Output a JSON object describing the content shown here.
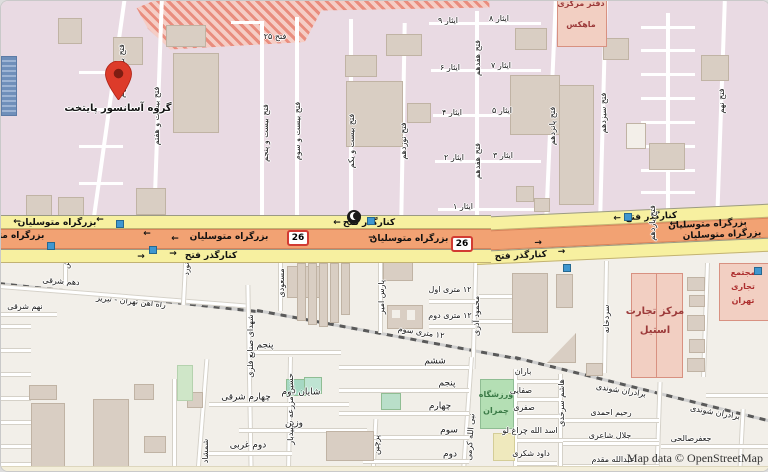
{
  "attribution": "Map data © OpenStreetMap",
  "roads": {
    "highway_main": "بزرگراه متوسلیان",
    "highway_side": "کنارگذر فتح",
    "shield": "26",
    "railway": "راه آهن تهران - تبریز"
  },
  "streets": {
    "fath29": "فتح بیست و نهم",
    "fath27": "فتح بیست و هفتم",
    "fath25_short": "فتح ۲۵",
    "fath25": "فتح بیست و پنجم",
    "fath23": "فتح بیست و سوم",
    "fath21": "فتح بیست و یکم",
    "fath19": "فتح نوزدهم",
    "fath17": "فتح هفدهم",
    "fath15": "فتح پانزدهم",
    "fath13": "فتح سیزدهم",
    "fath11": "فتح یازدهم",
    "fath9": "فتح نهم",
    "isar1": "ایثار ۱",
    "isar2": "ایثار ۲",
    "isar3": "ایثار ۳",
    "isar4": "ایثار ۴",
    "isar5": "ایثار ۵",
    "isar6": "ایثار ۶",
    "isar7": "ایثار ۷",
    "isar8": "ایثار ۸",
    "isar9": "ایثار ۹",
    "dahom_sharghi": "دهم شرقی",
    "nohom_sharghi": "نهم شرقی",
    "shohada": "شهدای صنایع فلزی",
    "navard": "نورد",
    "joosh": "جوش",
    "masoudi": "مسعودی",
    "pars_amir": "پارس امیر",
    "metri1": "۱۲ متری اول",
    "metri2": "۱۲ متری دوم",
    "metri3": "۱۲ متری سوم",
    "mahmoud_azari": "محمود آذری",
    "sardkhaneh": "سردخانه",
    "sheshom": "ششم",
    "panjom": "پنجم",
    "chaharom": "چهارم",
    "sevom": "سوم",
    "dovom": "دوم",
    "shemshad": "شمشاد",
    "chaharom_sharghi": "چهارم شرقی",
    "shayan_dovom": "شایان دوم",
    "hossein_mazraeh": "حسین مزرعه سپیدبار",
    "vazin": "وزین",
    "dovom_gharbi": "دوم غربی",
    "parchin": "پرچین",
    "nabiollah_karami": "نبی الله کرمی",
    "baran": "باران",
    "safaei": "صفایی",
    "safari": "صفری",
    "asadollah_cheraghlou": "اسد الله چراغ لو",
    "davood_shokri": "داود شکری",
    "hashem_sorkhedi": "هاشم سرخدی",
    "baradaran_shavandi": "برادران شوندی",
    "rahim_ahmadi": "رحیم احمدی",
    "jalal_shaeri": "جلال شاعری",
    "jafar_salehi": "جعفرصالحی",
    "abdollah_moghaddam": "عبدالله مقدم"
  },
  "places": {
    "pin_label": "گروه آسانسور پایتخت",
    "mahex_l1": "دفتر مرکزی",
    "mahex_l2": "ماهکس",
    "steel_l1": "مرکز تجارت",
    "steel_l2": "استیل",
    "complex_l1": "مجتمع",
    "complex_l2": "تجاری",
    "complex_l3": "تهران",
    "stadium_l1": "ورزشگاه",
    "stadium_l2": "چمران"
  },
  "icons": {
    "arrow_left": "←",
    "arrow_right": "→"
  },
  "colors": {
    "industrial_zone": "#e9dae3",
    "land": "#f2efe9",
    "trunk_road": "#f2a273",
    "side_road": "#f7f0a0",
    "pin_red": "#dd3b2a",
    "commercial_fill": "#f2cfc2",
    "commercial_text": "#9c3a3a",
    "sport_green": "#b4dfb4",
    "stop_blue": "#3f97d0",
    "railway_gray": "#5a5a5a"
  }
}
